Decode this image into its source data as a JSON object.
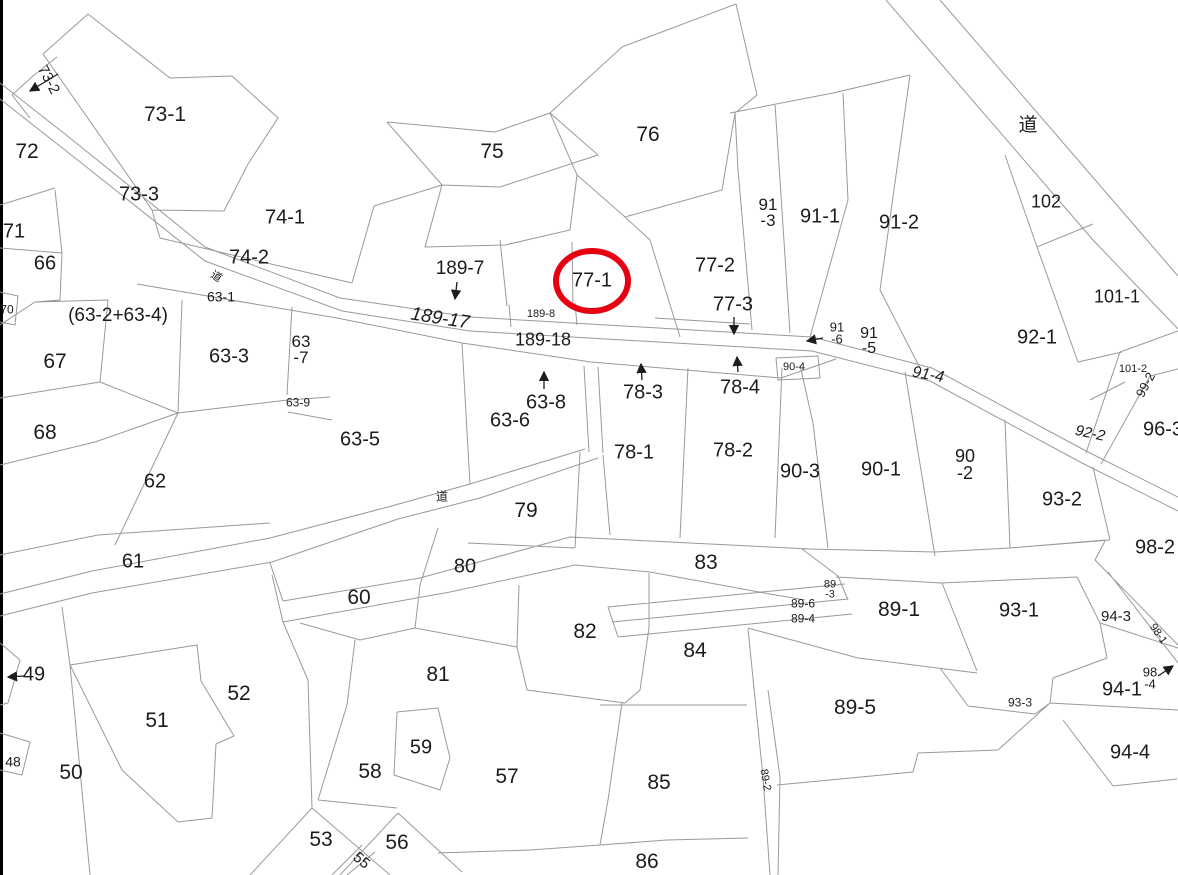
{
  "map": {
    "title": "cadastral-parcel-map",
    "colors": {
      "background": "#ffffff",
      "boundary_line": "#999999",
      "border_bar": "#000000",
      "label_text": "#1c1c1c",
      "highlight_red": "#e60012"
    },
    "highlight": {
      "parcel": "77-1",
      "cx": 592,
      "cy": 281,
      "rx": 36,
      "ry": 30,
      "stroke_width": 6
    },
    "labels": [
      {
        "id": "73-2",
        "text": "73-2",
        "x": 48,
        "y": 80,
        "size": 15,
        "rotate": 62
      },
      {
        "id": "72",
        "text": "72",
        "x": 27,
        "y": 152,
        "size": 21
      },
      {
        "id": "73-1",
        "text": "73-1",
        "x": 165,
        "y": 115,
        "size": 21
      },
      {
        "id": "73-3",
        "text": "73-3",
        "x": 139,
        "y": 195,
        "size": 20
      },
      {
        "id": "71",
        "text": "71",
        "x": 14,
        "y": 232,
        "size": 20
      },
      {
        "id": "66",
        "text": "66",
        "x": 45,
        "y": 264,
        "size": 20
      },
      {
        "id": "70",
        "text": "70",
        "x": 7,
        "y": 310,
        "size": 12
      },
      {
        "id": "63-2-63-4",
        "text": "(63-2+63-4)",
        "x": 118,
        "y": 316,
        "size": 19
      },
      {
        "id": "67",
        "text": "67",
        "x": 55,
        "y": 362,
        "size": 21
      },
      {
        "id": "68",
        "text": "68",
        "x": 45,
        "y": 433,
        "size": 21
      },
      {
        "id": "62",
        "text": "62",
        "x": 155,
        "y": 482,
        "size": 20
      },
      {
        "id": "61",
        "text": "61",
        "x": 133,
        "y": 562,
        "size": 20
      },
      {
        "id": "49",
        "text": "49",
        "x": 34,
        "y": 675,
        "size": 20
      },
      {
        "id": "48",
        "text": "48",
        "x": 13,
        "y": 762,
        "size": 14
      },
      {
        "id": "50",
        "text": "50",
        "x": 71,
        "y": 773,
        "size": 21
      },
      {
        "id": "51",
        "text": "51",
        "x": 157,
        "y": 721,
        "size": 21
      },
      {
        "id": "52",
        "text": "52",
        "x": 239,
        "y": 694,
        "size": 21
      },
      {
        "id": "74-1",
        "text": "74-1",
        "x": 285,
        "y": 218,
        "size": 20
      },
      {
        "id": "74-2",
        "text": "74-2",
        "x": 249,
        "y": 258,
        "size": 20
      },
      {
        "id": "road-upper-left",
        "text": "道",
        "x": 216,
        "y": 277,
        "size": 11,
        "rotate": 33
      },
      {
        "id": "63-1",
        "text": "63-1",
        "x": 221,
        "y": 297,
        "size": 14
      },
      {
        "id": "63-3",
        "text": "63-3",
        "x": 229,
        "y": 357,
        "size": 20
      },
      {
        "id": "63-7",
        "text": "63\n-7",
        "x": 301,
        "y": 350,
        "size": 17
      },
      {
        "id": "63-9",
        "text": "63-9",
        "x": 298,
        "y": 403,
        "size": 12
      },
      {
        "id": "63-5",
        "text": "63-5",
        "x": 360,
        "y": 440,
        "size": 20
      },
      {
        "id": "63-6",
        "text": "63-6",
        "x": 510,
        "y": 421,
        "size": 20
      },
      {
        "id": "63-8",
        "text": "63-8",
        "x": 546,
        "y": 403,
        "size": 20
      },
      {
        "id": "75",
        "text": "75",
        "x": 492,
        "y": 152,
        "size": 21
      },
      {
        "id": "76",
        "text": "76",
        "x": 648,
        "y": 135,
        "size": 21
      },
      {
        "id": "189-7",
        "text": "189-7",
        "x": 460,
        "y": 269,
        "size": 19
      },
      {
        "id": "189-17",
        "text": "189-17",
        "x": 440,
        "y": 319,
        "size": 19,
        "rotate": 9,
        "italic": true
      },
      {
        "id": "189-8",
        "text": "189-8",
        "x": 541,
        "y": 314,
        "size": 11
      },
      {
        "id": "189-18",
        "text": "189-18",
        "x": 543,
        "y": 340,
        "size": 18
      },
      {
        "id": "77-1",
        "text": "77-1",
        "x": 592,
        "y": 281,
        "size": 20
      },
      {
        "id": "77-2",
        "text": "77-2",
        "x": 715,
        "y": 266,
        "size": 20
      },
      {
        "id": "77-3",
        "text": "77-3",
        "x": 733,
        "y": 305,
        "size": 20
      },
      {
        "id": "78-3",
        "text": "78-3",
        "x": 643,
        "y": 393,
        "size": 20
      },
      {
        "id": "78-4",
        "text": "78-4",
        "x": 740,
        "y": 388,
        "size": 20
      },
      {
        "id": "78-1",
        "text": "78-1",
        "x": 634,
        "y": 453,
        "size": 20
      },
      {
        "id": "78-2",
        "text": "78-2",
        "x": 733,
        "y": 451,
        "size": 20
      },
      {
        "id": "79",
        "text": "79",
        "x": 526,
        "y": 511,
        "size": 21
      },
      {
        "id": "road-middle",
        "text": "道",
        "x": 442,
        "y": 497,
        "size": 12
      },
      {
        "id": "80",
        "text": "80",
        "x": 465,
        "y": 567,
        "size": 20
      },
      {
        "id": "60",
        "text": "60",
        "x": 359,
        "y": 598,
        "size": 21
      },
      {
        "id": "81",
        "text": "81",
        "x": 438,
        "y": 675,
        "size": 21
      },
      {
        "id": "82",
        "text": "82",
        "x": 585,
        "y": 632,
        "size": 21
      },
      {
        "id": "59",
        "text": "59",
        "x": 421,
        "y": 748,
        "size": 20
      },
      {
        "id": "58",
        "text": "58",
        "x": 370,
        "y": 772,
        "size": 21
      },
      {
        "id": "57",
        "text": "57",
        "x": 507,
        "y": 777,
        "size": 21
      },
      {
        "id": "53",
        "text": "53",
        "x": 321,
        "y": 840,
        "size": 21
      },
      {
        "id": "55",
        "text": "55",
        "x": 361,
        "y": 861,
        "size": 15,
        "rotate": 40
      },
      {
        "id": "56",
        "text": "56",
        "x": 397,
        "y": 843,
        "size": 21
      },
      {
        "id": "86",
        "text": "86",
        "x": 647,
        "y": 862,
        "size": 21
      },
      {
        "id": "85",
        "text": "85",
        "x": 659,
        "y": 783,
        "size": 21
      },
      {
        "id": "84",
        "text": "84",
        "x": 695,
        "y": 651,
        "size": 21
      },
      {
        "id": "83",
        "text": "83",
        "x": 706,
        "y": 563,
        "size": 21
      },
      {
        "id": "89-3",
        "text": "89\n-3",
        "x": 830,
        "y": 590,
        "size": 11
      },
      {
        "id": "89-6",
        "text": "89-6",
        "x": 803,
        "y": 604,
        "size": 12
      },
      {
        "id": "89-4",
        "text": "89-4",
        "x": 803,
        "y": 619,
        "size": 12
      },
      {
        "id": "89-1",
        "text": "89-1",
        "x": 899,
        "y": 610,
        "size": 21
      },
      {
        "id": "89-5",
        "text": "89-5",
        "x": 855,
        "y": 708,
        "size": 21
      },
      {
        "id": "89-2",
        "text": "89-2",
        "x": 765,
        "y": 780,
        "size": 11,
        "rotate": 80
      },
      {
        "id": "90-3",
        "text": "90-3",
        "x": 800,
        "y": 472,
        "size": 20
      },
      {
        "id": "90-1",
        "text": "90-1",
        "x": 881,
        "y": 470,
        "size": 20
      },
      {
        "id": "90-2",
        "text": "90\n-2",
        "x": 965,
        "y": 465,
        "size": 18
      },
      {
        "id": "90-4",
        "text": "90-4",
        "x": 794,
        "y": 367,
        "size": 11
      },
      {
        "id": "91-3",
        "text": "91\n-3",
        "x": 768,
        "y": 213,
        "size": 17
      },
      {
        "id": "91-1",
        "text": "91-1",
        "x": 820,
        "y": 217,
        "size": 20
      },
      {
        "id": "91-2",
        "text": "91-2",
        "x": 899,
        "y": 223,
        "size": 20
      },
      {
        "id": "91-6",
        "text": "91\n-6",
        "x": 837,
        "y": 334,
        "size": 13
      },
      {
        "id": "91-5",
        "text": "91\n-5",
        "x": 869,
        "y": 341,
        "size": 16
      },
      {
        "id": "91-4",
        "text": "91-4",
        "x": 928,
        "y": 375,
        "size": 16,
        "rotate": 10,
        "italic": true
      },
      {
        "id": "92-1",
        "text": "92-1",
        "x": 1037,
        "y": 338,
        "size": 20
      },
      {
        "id": "92-2",
        "text": "92-2",
        "x": 1090,
        "y": 434,
        "size": 15,
        "rotate": 12,
        "italic": true
      },
      {
        "id": "93-2",
        "text": "93-2",
        "x": 1062,
        "y": 500,
        "size": 20
      },
      {
        "id": "93-1",
        "text": "93-1",
        "x": 1019,
        "y": 611,
        "size": 20
      },
      {
        "id": "93-3",
        "text": "93-3",
        "x": 1020,
        "y": 703,
        "size": 12
      },
      {
        "id": "94-3",
        "text": "94-3",
        "x": 1116,
        "y": 617,
        "size": 15
      },
      {
        "id": "94-1",
        "text": "94-1",
        "x": 1122,
        "y": 690,
        "size": 20
      },
      {
        "id": "98-4",
        "text": "98\n-4",
        "x": 1150,
        "y": 679,
        "size": 13
      },
      {
        "id": "94-4",
        "text": "94-4",
        "x": 1130,
        "y": 753,
        "size": 20
      },
      {
        "id": "96-3",
        "text": "96-3",
        "x": 1163,
        "y": 430,
        "size": 20
      },
      {
        "id": "98-1",
        "text": "98-1",
        "x": 1158,
        "y": 634,
        "size": 11,
        "rotate": 55
      },
      {
        "id": "98-2",
        "text": "98-2",
        "x": 1155,
        "y": 548,
        "size": 20
      },
      {
        "id": "99-2",
        "text": "99-2",
        "x": 1146,
        "y": 385,
        "size": 13,
        "rotate": -62
      },
      {
        "id": "101-1",
        "text": "101-1",
        "x": 1117,
        "y": 297,
        "size": 18
      },
      {
        "id": "101-2",
        "text": "101-2",
        "x": 1133,
        "y": 369,
        "size": 11
      },
      {
        "id": "102",
        "text": "102",
        "x": 1046,
        "y": 202,
        "size": 18
      },
      {
        "id": "road-upper-right",
        "text": "道",
        "x": 1028,
        "y": 126,
        "size": 19
      }
    ],
    "arrows": [
      {
        "for": "73-2",
        "x1": 58,
        "y1": 74,
        "x2": 30,
        "y2": 91
      },
      {
        "for": "49",
        "x1": 24,
        "y1": 676,
        "x2": 8,
        "y2": 677
      },
      {
        "for": "189-7",
        "x1": 457,
        "y1": 282,
        "x2": 455,
        "y2": 299
      },
      {
        "for": "77-3",
        "x1": 734,
        "y1": 317,
        "x2": 734,
        "y2": 334
      },
      {
        "for": "63-8",
        "x1": 544,
        "y1": 389,
        "x2": 544,
        "y2": 372
      },
      {
        "for": "78-3",
        "x1": 642,
        "y1": 380,
        "x2": 641,
        "y2": 364
      },
      {
        "for": "78-4",
        "x1": 738,
        "y1": 372,
        "x2": 737,
        "y2": 357
      },
      {
        "for": "91-6",
        "x1": 823,
        "y1": 338,
        "x2": 807,
        "y2": 341
      },
      {
        "for": "98-4",
        "x1": 1158,
        "y1": 676,
        "x2": 1173,
        "y2": 666
      }
    ]
  }
}
